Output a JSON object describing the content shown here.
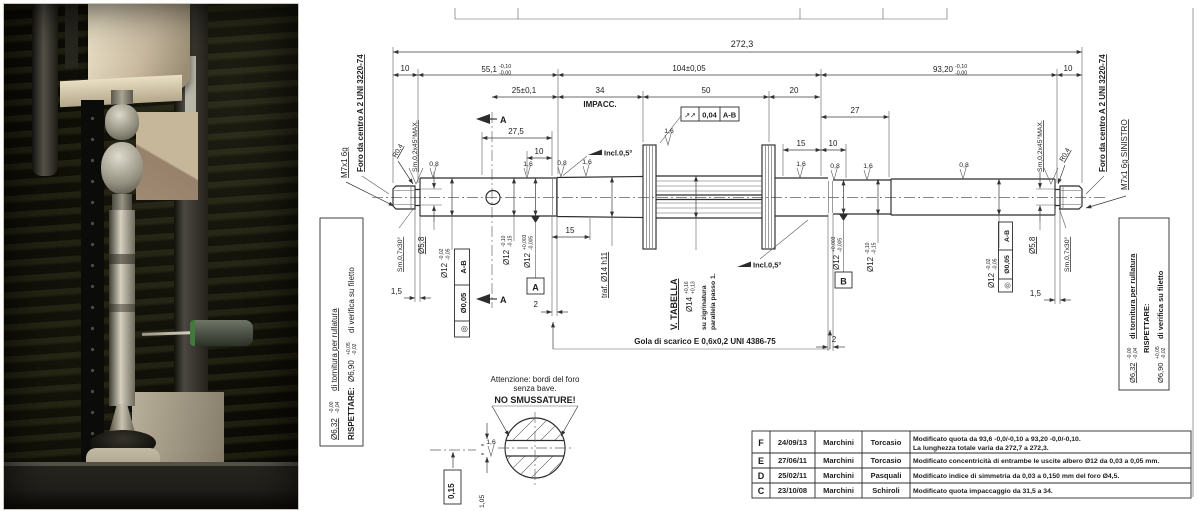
{
  "drawing": {
    "dims": {
      "total": "272,3",
      "thread_left": "10",
      "thread_right": "10",
      "len551": "55,1",
      "len551_up": "-0,10",
      "len551_dn": "-0,00",
      "len104": "104±0,05",
      "len932": "93,20",
      "len932_up": "-0,10",
      "len932_dn": "-0,00",
      "len25": "25±0,1",
      "len34": "34",
      "len50": "50",
      "len20": "20",
      "len27": "27",
      "len275": "27,5",
      "len10a": "10",
      "len10b": "10",
      "len15a": "15",
      "len15b": "15",
      "groove_l": "2",
      "groove_r": "2",
      "neck_l": "1,5",
      "neck_r": "1,5"
    },
    "labels": {
      "impacc": "IMPACC.",
      "foro": "Foro da centro A 2 UNI 3220-74",
      "thread_left": "M7x1 6g",
      "thread_right": "M7x1 6g SINISTRO",
      "r04": "R0,4",
      "cham45": "Sm,0,2x45°MAX.",
      "cham30": "Sm,0,7x30°",
      "d58": "Ø5,8",
      "traf": "traf. Ø14 h11",
      "v_tabella": "V. TABELLA",
      "zigr1": "su zigrinatura",
      "zigr2": "parallela passo 1.",
      "incl": "Incl.0,5°",
      "gola": "Gola di scarico E 0,6x0,2 UNI 4386-75"
    },
    "diameters": {
      "d12": "Ø12",
      "d14": "Ø14",
      "d12a_up": "-0,02",
      "d12a_dn": "-0,05",
      "d12b_up": "-0,10",
      "d12b_dn": "-0,15",
      "d12c_up": "+0,003",
      "d12c_dn": "-0,005",
      "d14_up": "+0,16",
      "d14_dn": "+0,13"
    },
    "gdnt": {
      "conc_sym": "◎",
      "conc_val": "Ø0,05",
      "conc_ref": "A-B",
      "runout_sym": "↗↗",
      "runout_val": "0,04",
      "runout_ref": "A-B",
      "datum_a": "A",
      "datum_b": "B",
      "section_a": "A"
    },
    "roughness": {
      "r08": "0,8",
      "r16": "1,6"
    },
    "side_note": {
      "l1_val": "Ø6,32",
      "l1_up": "-0,00",
      "l1_dn": "-0,04",
      "l1_txt": "di tornitura per rullatura",
      "l2_label": "RISPETTARE:",
      "l2_val": "Ø6,90",
      "l2_up": "+0,05",
      "l2_dn": "-0,02",
      "l2_txt": "di verifica su filetto"
    },
    "detail": {
      "warn1": "Attenzione: bordi del foro",
      "warn2": "senza bave.",
      "warn3": "NO SMUSSATURE!",
      "dim015": "0,15",
      "dim105": "1,05",
      "eq": "="
    },
    "rev_table": {
      "rows": [
        {
          "rev": "F",
          "date": "24/09/13",
          "drawn": "Marchini",
          "appr": "Torcasio",
          "desc1": "Modificato quota da 93,6 -0,0/-0,10 a 93,20 -0,0/-0,10.",
          "desc2": "La lunghezza totale varia da 272,7 a 272,3."
        },
        {
          "rev": "E",
          "date": "27/06/11",
          "drawn": "Marchini",
          "appr": "Torcasio",
          "desc1": "Modificato concentricità di entrambe le uscite albero Ø12 da 0,03 a 0,05 mm.",
          "desc2": ""
        },
        {
          "rev": "D",
          "date": "25/02/11",
          "drawn": "Marchini",
          "appr": "Pasquali",
          "desc1": "Modificato indice di simmetria da 0,03 a 0,150 mm del foro Ø4,5.",
          "desc2": ""
        },
        {
          "rev": "C",
          "date": "23/10/08",
          "drawn": "Marchini",
          "appr": "Schiroli",
          "desc1": "Modificato quota impaccaggio da 31,5 a 34.",
          "desc2": ""
        }
      ]
    }
  }
}
